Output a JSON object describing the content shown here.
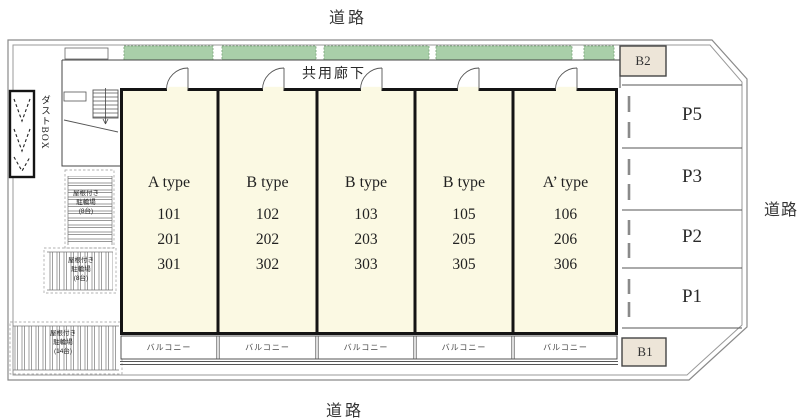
{
  "roads": {
    "top": "道路",
    "bottom": "道路",
    "right": "道路"
  },
  "building": {
    "corridor_label": "共用廊下",
    "balcony_label": "バルコニー",
    "units": [
      {
        "type": "A type",
        "rooms": [
          "101",
          "201",
          "301"
        ]
      },
      {
        "type": "B type",
        "rooms": [
          "102",
          "202",
          "302"
        ]
      },
      {
        "type": "B type",
        "rooms": [
          "103",
          "203",
          "303"
        ]
      },
      {
        "type": "B type",
        "rooms": [
          "105",
          "205",
          "305"
        ]
      },
      {
        "type": "A’ type",
        "rooms": [
          "106",
          "206",
          "306"
        ]
      }
    ]
  },
  "parking": {
    "stalls": [
      "P5",
      "P3",
      "P2",
      "P1"
    ],
    "b2_label": "B2",
    "b1_label": "B1"
  },
  "facilities": {
    "dust_box_label": "ダストBOX",
    "bike_parking_upper": [
      "屋根付き",
      "駐輪場",
      "(8台)"
    ],
    "bike_parking_middle": [
      "屋根付き",
      "駐輪場",
      "(8台)"
    ],
    "bike_parking_lower": [
      "屋根付き",
      "駐輪場",
      "(14台)"
    ]
  },
  "colors": {
    "unit_fill": "#FBF9E3",
    "planting_green": "#A9CFA9",
    "planting_edge": "#7FA87F",
    "marker_beige": "#EDE5D8",
    "wall_black": "#141414",
    "boundary_gray": "#8a8a8a"
  }
}
